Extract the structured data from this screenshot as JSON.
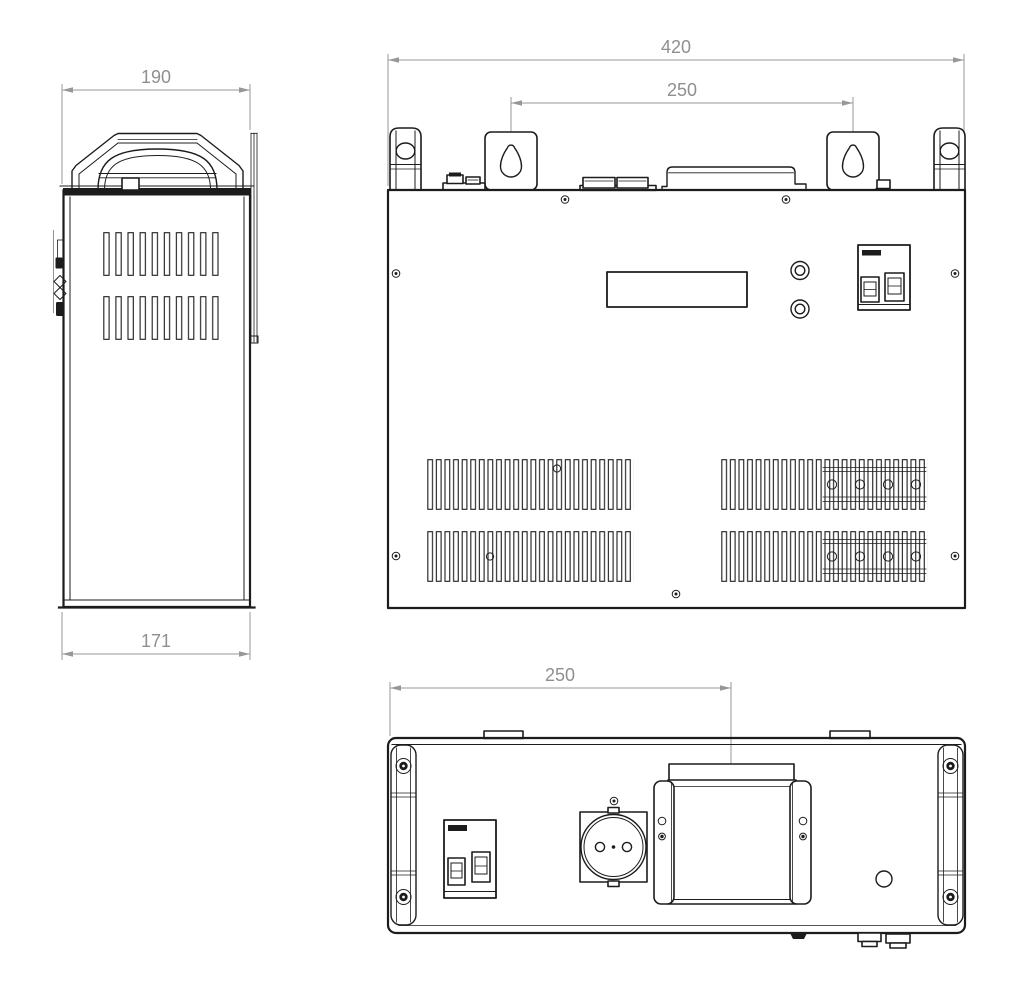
{
  "drawing": {
    "type": "technical-orthographic-drawing",
    "background_color": "#ffffff",
    "line_color": "#1c1c1c",
    "dimension_color": "#8f8f8f",
    "views": {
      "side_view": {
        "dimensions": {
          "top_width_mm": "190",
          "bottom_depth_mm": "171"
        },
        "parts": [
          "carry-handle",
          "vent-slot-rows",
          "mounting-plate-edge",
          "front-panel-controls-edge"
        ]
      },
      "front_view": {
        "dimensions": {
          "overall_width_mm": "420",
          "mount_spacing_mm": "250"
        },
        "parts": [
          "keyhole-mounting-bracket-left",
          "keyhole-mounting-bracket-right",
          "carry-handle-left",
          "carry-handle-right",
          "terminal-cover",
          "lcd-display-window",
          "control-button-top",
          "control-button-bottom",
          "circuit-breaker",
          "ventilation-grilles",
          "screw-holes"
        ]
      },
      "bottom_view": {
        "dimensions": {
          "center_offset_mm": "250"
        },
        "parts": [
          "handle-left",
          "handle-right",
          "circuit-breaker",
          "power-socket",
          "terminal-box",
          "round-opening",
          "cable-connectors"
        ]
      }
    }
  }
}
